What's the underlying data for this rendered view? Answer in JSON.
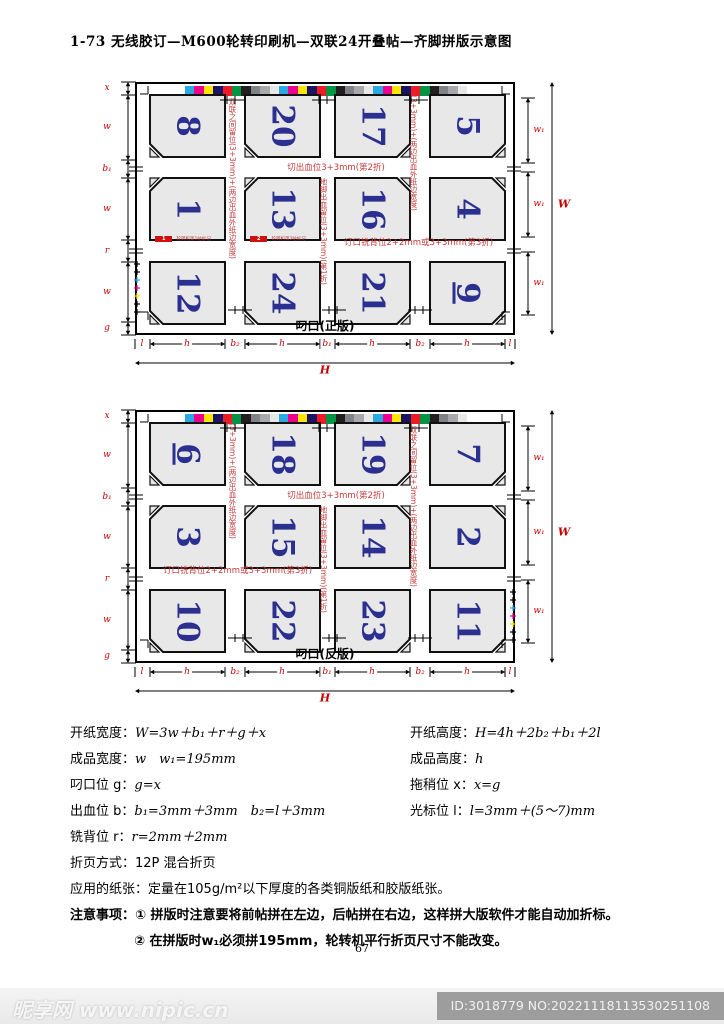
{
  "title": "1-73 无线胶订—M600轮转印刷机—双联24开叠帖—齐脚拼版示意图",
  "colors": {
    "annotation_red": "#c43b3b",
    "dimension_red": "#c00000",
    "page_number_blue": "#2b2f90",
    "cell_gray": "#e8e8e8",
    "mark_red": "#cc1111"
  },
  "color_bar": [
    "#29abe2",
    "#ec008c",
    "#ffe600",
    "#1b1464",
    "#ed1c24",
    "#009444",
    "#231f20",
    "#808285",
    "#a7a9ac",
    "#e8e8e8",
    "#29abe2",
    "#ec008c",
    "#ffe600",
    "#1b1464",
    "#ed1c24",
    "#009444",
    "#231f20",
    "#808285",
    "#a7a9ac",
    "#e8e8e8",
    "#29abe2",
    "#ec008c",
    "#ffe600",
    "#1b1464",
    "#ed1c24",
    "#009444",
    "#231f20",
    "#808285",
    "#a7a9ac",
    "#e8e8e8"
  ],
  "diagrams": [
    {
      "grip_label": "叼口(正版)",
      "pages": [
        [
          "8",
          "20",
          "17",
          "5"
        ],
        [
          "1",
          "13",
          "16",
          "4"
        ],
        [
          "12",
          "24",
          "21",
          "9"
        ]
      ],
      "underlined_page": "9",
      "left_labels": [
        "x",
        "w",
        "b₁",
        "w",
        "r",
        "w",
        "g"
      ],
      "right_segment_label": "w₁",
      "right_total_label": "W",
      "bottom_labels": [
        "l",
        "h",
        "b₂",
        "h",
        "b₁",
        "h",
        "b₂",
        "h",
        "l"
      ],
      "bottom_total_label": "H",
      "v_annotations": [
        "双联之间留位(3+3mm)+(两边出血外纸边宽度)",
        "地脚出血留位(3+3mm)(第1折)",
        "(3+3mm)+(两边出血外纸边宽度)"
      ],
      "h_annotations": [
        "切出血位3+3mm(第2折)",
        "订口铣背位2+2mm或3+3mm(第3折)"
      ],
      "sig_marks": [
        {
          "num": "1",
          "label": "轮转机第1帖标记"
        },
        {
          "num": "2",
          "label": "轮转机第2帖标记"
        }
      ]
    },
    {
      "grip_label": "叼口(反版)",
      "pages": [
        [
          "6",
          "18",
          "19",
          "7"
        ],
        [
          "3",
          "15",
          "14",
          "2"
        ],
        [
          "10",
          "22",
          "23",
          "11"
        ]
      ],
      "underlined_page": "6",
      "left_labels": [
        "x",
        "w",
        "b₁",
        "w",
        "r",
        "w",
        "g"
      ],
      "right_segment_label": "w₁",
      "right_total_label": "W",
      "bottom_labels": [
        "l",
        "h",
        "b₂",
        "h",
        "b₁",
        "h",
        "b₂",
        "h",
        "l"
      ],
      "bottom_total_label": "H",
      "v_annotations": [
        "(3+3mm)+(两边出血外纸边宽度)",
        "地脚出血留位(3+3mm)(第1折)",
        "双联之间留位(3+3mm)+(两边出血外纸边宽度)"
      ],
      "h_annotations": [
        "切出血位3+3mm(第2折)",
        "订口铣背位2+2mm或3+3mm(第3折)"
      ],
      "sig_marks": []
    }
  ],
  "formulas": {
    "left": [
      {
        "label": "开纸宽度：",
        "value": "W=3w＋b₁＋r＋g＋x"
      },
      {
        "label": "成品宽度：",
        "value": "w　w₁=195mm"
      },
      {
        "label": "叼口位 g：",
        "value": "g=x"
      },
      {
        "label": "出血位 b：",
        "value": "b₁=3mm＋3mm　b₂=l＋3mm"
      },
      {
        "label": "铣背位 r：",
        "value": "r=2mm＋2mm"
      },
      {
        "label": "折页方式：",
        "value": "12P 混合折页"
      },
      {
        "label": "应用的纸张：",
        "value": "定量在105g/m²以下厚度的各类铜版纸和胶版纸张。"
      }
    ],
    "right": [
      {
        "label": "开纸高度：",
        "value": "H=4h＋2b₂＋b₁＋2l"
      },
      {
        "label": "成品高度：",
        "value": "h"
      },
      {
        "label": "拖稍位 x：",
        "value": "x=g"
      },
      {
        "label": "光标位 l：",
        "value": "l=3mm＋(5～7)mm"
      }
    ]
  },
  "notes": {
    "heading": "注意事项：",
    "items": [
      "① 拼版时注意要将前帖拼在左边，后帖拼在右边，这样拼大版软件才能自动加折标。",
      "② 在拼版时w₁必须拼195mm，轮转机平行折页尺寸不能改变。"
    ]
  },
  "page_number": "67",
  "watermark": {
    "site_name": "昵享网",
    "site_url": "www.nipic.cn",
    "id_label": "ID:3018779 NO:20221118113530251108"
  }
}
